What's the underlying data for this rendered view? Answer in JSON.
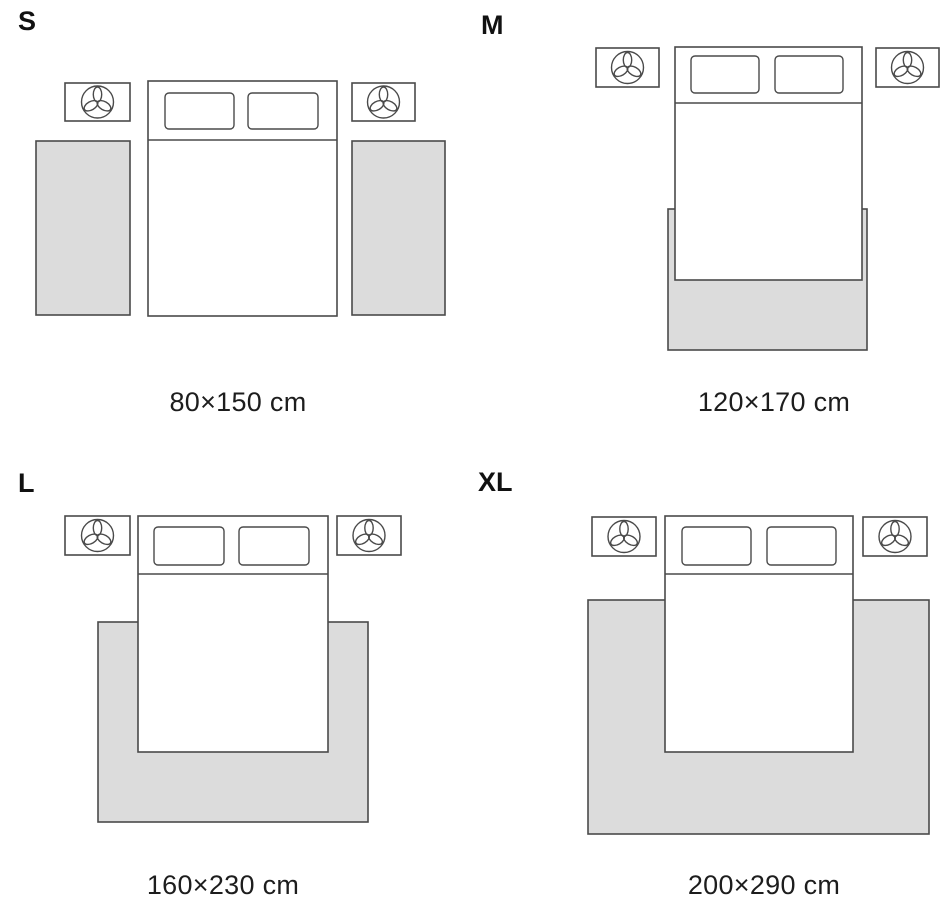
{
  "page": {
    "background": "#ffffff",
    "content_type": "rug-size-guide"
  },
  "colors": {
    "outline": "#4a4a4a",
    "rug_fill": "#dcdcdc",
    "furniture_fill": "#ffffff",
    "title_text": "#111111",
    "caption_text": "#1d1d1d"
  },
  "icons": {
    "nightstand_decor": "plant-icon"
  },
  "sizes": [
    {
      "label": "S",
      "dimensions": "80×150 cm",
      "width_cm": 80,
      "length_cm": 150,
      "rug_count": 2
    },
    {
      "label": "M",
      "dimensions": "120×170 cm",
      "width_cm": 120,
      "length_cm": 170,
      "rug_count": 1
    },
    {
      "label": "L",
      "dimensions": "160×230 cm",
      "width_cm": 160,
      "length_cm": 230,
      "rug_count": 1
    },
    {
      "label": "XL",
      "dimensions": "200×290 cm",
      "width_cm": 200,
      "length_cm": 290,
      "rug_count": 1
    }
  ]
}
